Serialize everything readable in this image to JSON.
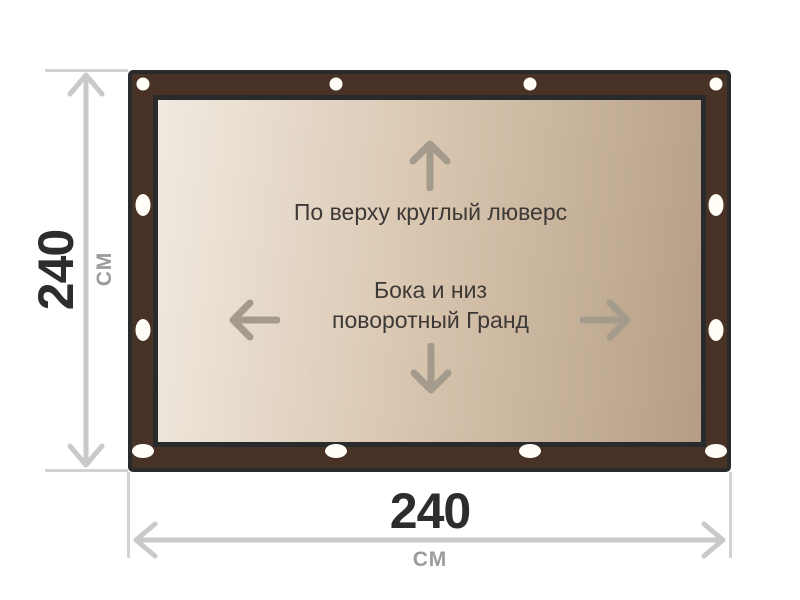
{
  "diagram": {
    "top_fastening_label": "По верху круглый люверс",
    "side_fastening_label_line1": "Бока и низ",
    "side_fastening_label_line2": "поворотный Гранд"
  },
  "dimensions": {
    "height": {
      "value": "240",
      "unit": "см"
    },
    "width": {
      "value": "240",
      "unit": "см"
    }
  },
  "colors": {
    "frame_brown": "#473225",
    "frame_outline": "#282a2c",
    "canvas_gradient_start": "#f1eae1",
    "canvas_gradient_end": "#b49d84",
    "eyelet_white": "#fffdf6",
    "direction_arrow_gray": "#a59b8d",
    "dimension_arrow_gray": "#c9c9c9",
    "text_dark": "#3d3936",
    "dimension_value_dark": "#2d2d2d",
    "dimension_unit_gray": "#9c9c9c"
  },
  "eyelets": [
    {
      "type": "circle",
      "x": 11,
      "y": 10
    },
    {
      "type": "circle",
      "x": 204,
      "y": 10
    },
    {
      "type": "circle",
      "x": 398,
      "y": 10
    },
    {
      "type": "circle",
      "x": 584,
      "y": 10
    },
    {
      "type": "oval-v",
      "x": 11,
      "y": 131
    },
    {
      "type": "oval-v",
      "x": 11,
      "y": 256
    },
    {
      "type": "oval-v",
      "x": 584,
      "y": 131
    },
    {
      "type": "oval-v",
      "x": 584,
      "y": 256
    },
    {
      "type": "oval-h",
      "x": 11,
      "y": 377
    },
    {
      "type": "oval-h",
      "x": 204,
      "y": 377
    },
    {
      "type": "oval-h",
      "x": 398,
      "y": 377
    },
    {
      "type": "oval-h",
      "x": 584,
      "y": 377
    }
  ]
}
